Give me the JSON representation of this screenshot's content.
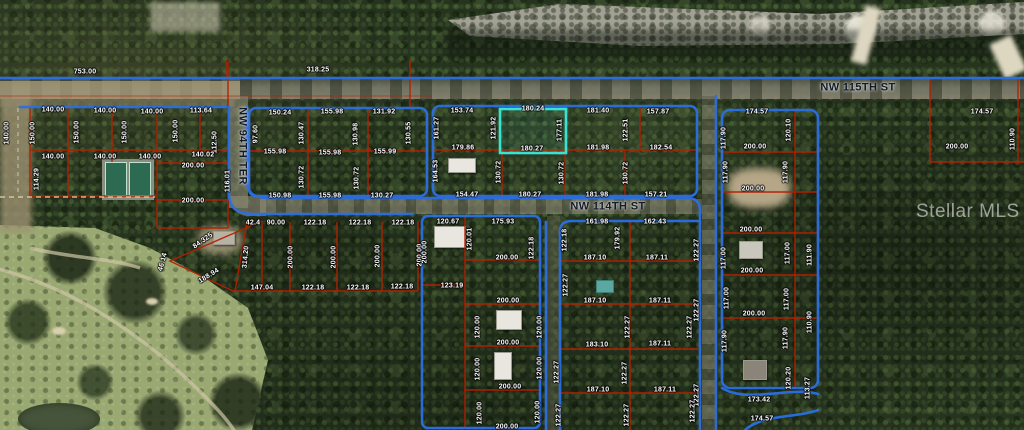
{
  "watermark": "Stellar MLS",
  "colors": {
    "road": "#2b6fe3",
    "parcel": "#b42000",
    "highlight": "#38e3d4",
    "dashed": "#ded8a8"
  },
  "streets": [
    {
      "label": "NW 115TH ST",
      "x": 858,
      "y": 88,
      "r": 0
    },
    {
      "label": "NW 114TH ST",
      "x": 608,
      "y": 207,
      "r": 0
    },
    {
      "label": "NW 94TH TER",
      "x": 242,
      "y": 146,
      "r": 90
    }
  ],
  "highlight_parcel": {
    "top": "180.24",
    "bottom": "180.27",
    "side": "177.11"
  },
  "labels": [
    {
      "t": "753.00",
      "x": 85,
      "y": 72,
      "r": 0
    },
    {
      "t": "318.25",
      "x": 318,
      "y": 70,
      "r": 0
    },
    {
      "t": "140.00",
      "x": 53,
      "y": 110,
      "r": 0
    },
    {
      "t": "140.00",
      "x": 105,
      "y": 111,
      "r": 0
    },
    {
      "t": "140.00",
      "x": 152,
      "y": 112,
      "r": 0
    },
    {
      "t": "113.64",
      "x": 201,
      "y": 111,
      "r": 0
    },
    {
      "t": "140.00",
      "x": 7,
      "y": 133,
      "r": -90
    },
    {
      "t": "150.00",
      "x": 33,
      "y": 133,
      "r": -90
    },
    {
      "t": "150.00",
      "x": 77,
      "y": 132,
      "r": -90
    },
    {
      "t": "150.00",
      "x": 125,
      "y": 132,
      "r": -90
    },
    {
      "t": "150.00",
      "x": 176,
      "y": 131,
      "r": -90
    },
    {
      "t": "112.50",
      "x": 215,
      "y": 142,
      "r": -90
    },
    {
      "t": "140.00",
      "x": 53,
      "y": 157,
      "r": 0
    },
    {
      "t": "140.00",
      "x": 105,
      "y": 157,
      "r": 0
    },
    {
      "t": "140.00",
      "x": 150,
      "y": 157,
      "r": 0
    },
    {
      "t": "140.02",
      "x": 203,
      "y": 155,
      "r": 0
    },
    {
      "t": "200.00",
      "x": 193,
      "y": 166,
      "r": 0
    },
    {
      "t": "114.29",
      "x": 37,
      "y": 179,
      "r": -90
    },
    {
      "t": "116.01",
      "x": 228,
      "y": 181,
      "r": -90
    },
    {
      "t": "200.00",
      "x": 193,
      "y": 201,
      "r": 0
    },
    {
      "t": "150.24",
      "x": 280,
      "y": 113,
      "r": 0
    },
    {
      "t": "155.98",
      "x": 332,
      "y": 112,
      "r": 0
    },
    {
      "t": "131.92",
      "x": 384,
      "y": 112,
      "r": 0
    },
    {
      "t": "97.60",
      "x": 256,
      "y": 134,
      "r": -90
    },
    {
      "t": "130.47",
      "x": 302,
      "y": 133,
      "r": -90
    },
    {
      "t": "130.98",
      "x": 356,
      "y": 134,
      "r": -90
    },
    {
      "t": "130.55",
      "x": 409,
      "y": 133,
      "r": -90
    },
    {
      "t": "155.98",
      "x": 275,
      "y": 152,
      "r": 0
    },
    {
      "t": "155.98",
      "x": 330,
      "y": 153,
      "r": 0
    },
    {
      "t": "155.99",
      "x": 385,
      "y": 152,
      "r": 0
    },
    {
      "t": "130.72",
      "x": 302,
      "y": 177,
      "r": -90
    },
    {
      "t": "130.72",
      "x": 357,
      "y": 178,
      "r": -90
    },
    {
      "t": "150.98",
      "x": 280,
      "y": 196,
      "r": 0
    },
    {
      "t": "155.98",
      "x": 330,
      "y": 196,
      "r": 0
    },
    {
      "t": "130.27",
      "x": 382,
      "y": 196,
      "r": 0
    },
    {
      "t": "153.74",
      "x": 462,
      "y": 111,
      "r": 0
    },
    {
      "t": "180.24",
      "x": 533,
      "y": 109,
      "r": 0
    },
    {
      "t": "181.40",
      "x": 598,
      "y": 111,
      "r": 0
    },
    {
      "t": "157.87",
      "x": 658,
      "y": 112,
      "r": 0
    },
    {
      "t": "161.27",
      "x": 437,
      "y": 128,
      "r": -90
    },
    {
      "t": "121.92",
      "x": 494,
      "y": 128,
      "r": -90
    },
    {
      "t": "177.11",
      "x": 560,
      "y": 130,
      "r": -90
    },
    {
      "t": "122.51",
      "x": 626,
      "y": 130,
      "r": -90
    },
    {
      "t": "179.86",
      "x": 463,
      "y": 148,
      "r": 0
    },
    {
      "t": "180.27",
      "x": 532,
      "y": 149,
      "r": 0
    },
    {
      "t": "181.98",
      "x": 598,
      "y": 148,
      "r": 0
    },
    {
      "t": "182.54",
      "x": 661,
      "y": 148,
      "r": 0
    },
    {
      "t": "164.53",
      "x": 436,
      "y": 171,
      "r": -90
    },
    {
      "t": "130.72",
      "x": 499,
      "y": 172,
      "r": -90
    },
    {
      "t": "130.72",
      "x": 562,
      "y": 173,
      "r": -90
    },
    {
      "t": "130.72",
      "x": 626,
      "y": 173,
      "r": -90
    },
    {
      "t": "154.47",
      "x": 467,
      "y": 195,
      "r": 0
    },
    {
      "t": "180.27",
      "x": 530,
      "y": 195,
      "r": 0
    },
    {
      "t": "181.98",
      "x": 597,
      "y": 195,
      "r": 0
    },
    {
      "t": "157.21",
      "x": 656,
      "y": 195,
      "r": 0
    },
    {
      "t": "174.57",
      "x": 757,
      "y": 112,
      "r": 0
    },
    {
      "t": "120.10",
      "x": 789,
      "y": 130,
      "r": -90
    },
    {
      "t": "117.90",
      "x": 724,
      "y": 138,
      "r": -90
    },
    {
      "t": "200.00",
      "x": 755,
      "y": 147,
      "r": 0
    },
    {
      "t": "117.90",
      "x": 726,
      "y": 172,
      "r": -90
    },
    {
      "t": "117.90",
      "x": 786,
      "y": 172,
      "r": -90
    },
    {
      "t": "200.00",
      "x": 753,
      "y": 189,
      "r": 0
    },
    {
      "t": "174.57",
      "x": 982,
      "y": 112,
      "r": 0
    },
    {
      "t": "200.00",
      "x": 957,
      "y": 147,
      "r": 0
    },
    {
      "t": "110.90",
      "x": 1013,
      "y": 139,
      "r": -90
    },
    {
      "t": "200.00",
      "x": 751,
      "y": 230,
      "r": 0
    },
    {
      "t": "117.00",
      "x": 724,
      "y": 258,
      "r": -90
    },
    {
      "t": "117.00",
      "x": 788,
      "y": 253,
      "r": -90
    },
    {
      "t": "200.00",
      "x": 752,
      "y": 271,
      "r": 0
    },
    {
      "t": "117.00",
      "x": 727,
      "y": 298,
      "r": -90
    },
    {
      "t": "117.00",
      "x": 787,
      "y": 299,
      "r": -90
    },
    {
      "t": "200.00",
      "x": 754,
      "y": 314,
      "r": 0
    },
    {
      "t": "117.90",
      "x": 725,
      "y": 341,
      "r": -90
    },
    {
      "t": "117.90",
      "x": 786,
      "y": 338,
      "r": -90
    },
    {
      "t": "120.20",
      "x": 789,
      "y": 378,
      "r": -90
    },
    {
      "t": "173.42",
      "x": 759,
      "y": 400,
      "r": 0
    },
    {
      "t": "174.57",
      "x": 762,
      "y": 419,
      "r": 0
    },
    {
      "t": "111.90",
      "x": 810,
      "y": 255,
      "r": -90
    },
    {
      "t": "110.90",
      "x": 810,
      "y": 322,
      "r": -90
    },
    {
      "t": "113.27",
      "x": 808,
      "y": 388,
      "r": -90
    },
    {
      "t": "122.27",
      "x": 697,
      "y": 250,
      "r": -90
    },
    {
      "t": "122.27",
      "x": 697,
      "y": 310,
      "r": -90
    },
    {
      "t": "122.27",
      "x": 697,
      "y": 395,
      "r": -90
    },
    {
      "t": "42.4",
      "x": 253,
      "y": 223,
      "r": 0
    },
    {
      "t": "90.00",
      "x": 276,
      "y": 223,
      "r": 0
    },
    {
      "t": "122.18",
      "x": 315,
      "y": 223,
      "r": 0
    },
    {
      "t": "122.18",
      "x": 360,
      "y": 223,
      "r": 0
    },
    {
      "t": "122.18",
      "x": 403,
      "y": 223,
      "r": 0
    },
    {
      "t": "84.325",
      "x": 203,
      "y": 241,
      "r": -35
    },
    {
      "t": "46.14",
      "x": 163,
      "y": 262,
      "r": -75
    },
    {
      "t": "188.94",
      "x": 209,
      "y": 276,
      "r": -32
    },
    {
      "t": "314.20",
      "x": 246,
      "y": 257,
      "r": -85
    },
    {
      "t": "200.00",
      "x": 291,
      "y": 257,
      "r": -90
    },
    {
      "t": "200.00",
      "x": 334,
      "y": 257,
      "r": -90
    },
    {
      "t": "200.00",
      "x": 378,
      "y": 256,
      "r": -90
    },
    {
      "t": "200.00",
      "x": 420,
      "y": 255,
      "r": -90
    },
    {
      "t": "147.04",
      "x": 262,
      "y": 288,
      "r": 0
    },
    {
      "t": "122.18",
      "x": 313,
      "y": 288,
      "r": 0
    },
    {
      "t": "122.18",
      "x": 358,
      "y": 288,
      "r": 0
    },
    {
      "t": "122.18",
      "x": 402,
      "y": 287,
      "r": 0
    },
    {
      "t": "120.67",
      "x": 448,
      "y": 222,
      "r": 0
    },
    {
      "t": "175.93",
      "x": 503,
      "y": 222,
      "r": 0
    },
    {
      "t": "120.01",
      "x": 470,
      "y": 239,
      "r": -90
    },
    {
      "t": "122.18",
      "x": 532,
      "y": 248,
      "r": -90
    },
    {
      "t": "200.00",
      "x": 425,
      "y": 252,
      "r": -90
    },
    {
      "t": "200.00",
      "x": 507,
      "y": 258,
      "r": 0
    },
    {
      "t": "123.19",
      "x": 452,
      "y": 286,
      "r": 0
    },
    {
      "t": "200.00",
      "x": 508,
      "y": 301,
      "r": 0
    },
    {
      "t": "120.00",
      "x": 478,
      "y": 327,
      "r": -90
    },
    {
      "t": "120.00",
      "x": 540,
      "y": 327,
      "r": -90
    },
    {
      "t": "200.00",
      "x": 508,
      "y": 343,
      "r": 0
    },
    {
      "t": "120.00",
      "x": 478,
      "y": 369,
      "r": -90
    },
    {
      "t": "120.00",
      "x": 540,
      "y": 368,
      "r": -90
    },
    {
      "t": "200.00",
      "x": 510,
      "y": 387,
      "r": 0
    },
    {
      "t": "120.00",
      "x": 480,
      "y": 413,
      "r": -90
    },
    {
      "t": "120.00",
      "x": 538,
      "y": 412,
      "r": -90
    },
    {
      "t": "200.00",
      "x": 507,
      "y": 427,
      "r": 0
    },
    {
      "t": "161.98",
      "x": 597,
      "y": 222,
      "r": 0
    },
    {
      "t": "162.43",
      "x": 655,
      "y": 222,
      "r": 0
    },
    {
      "t": "122.18",
      "x": 565,
      "y": 240,
      "r": -90
    },
    {
      "t": "179.92",
      "x": 618,
      "y": 238,
      "r": -90
    },
    {
      "t": "187.10",
      "x": 595,
      "y": 258,
      "r": 0
    },
    {
      "t": "187.11",
      "x": 657,
      "y": 258,
      "r": 0
    },
    {
      "t": "122.27",
      "x": 566,
      "y": 285,
      "r": -90
    },
    {
      "t": "187.10",
      "x": 595,
      "y": 301,
      "r": 0
    },
    {
      "t": "187.11",
      "x": 660,
      "y": 301,
      "r": 0
    },
    {
      "t": "122.27",
      "x": 628,
      "y": 327,
      "r": -90
    },
    {
      "t": "122.27",
      "x": 690,
      "y": 327,
      "r": -90
    },
    {
      "t": "183.10",
      "x": 597,
      "y": 345,
      "r": 0
    },
    {
      "t": "187.11",
      "x": 660,
      "y": 344,
      "r": 0
    },
    {
      "t": "122.27",
      "x": 557,
      "y": 372,
      "r": -90
    },
    {
      "t": "122.27",
      "x": 625,
      "y": 373,
      "r": -90
    },
    {
      "t": "187.10",
      "x": 598,
      "y": 390,
      "r": 0
    },
    {
      "t": "187.11",
      "x": 665,
      "y": 390,
      "r": 0
    },
    {
      "t": "122.27",
      "x": 559,
      "y": 415,
      "r": -90
    },
    {
      "t": "122.27",
      "x": 627,
      "y": 415,
      "r": -90
    },
    {
      "t": "122.27",
      "x": 693,
      "y": 411,
      "r": -90
    }
  ]
}
